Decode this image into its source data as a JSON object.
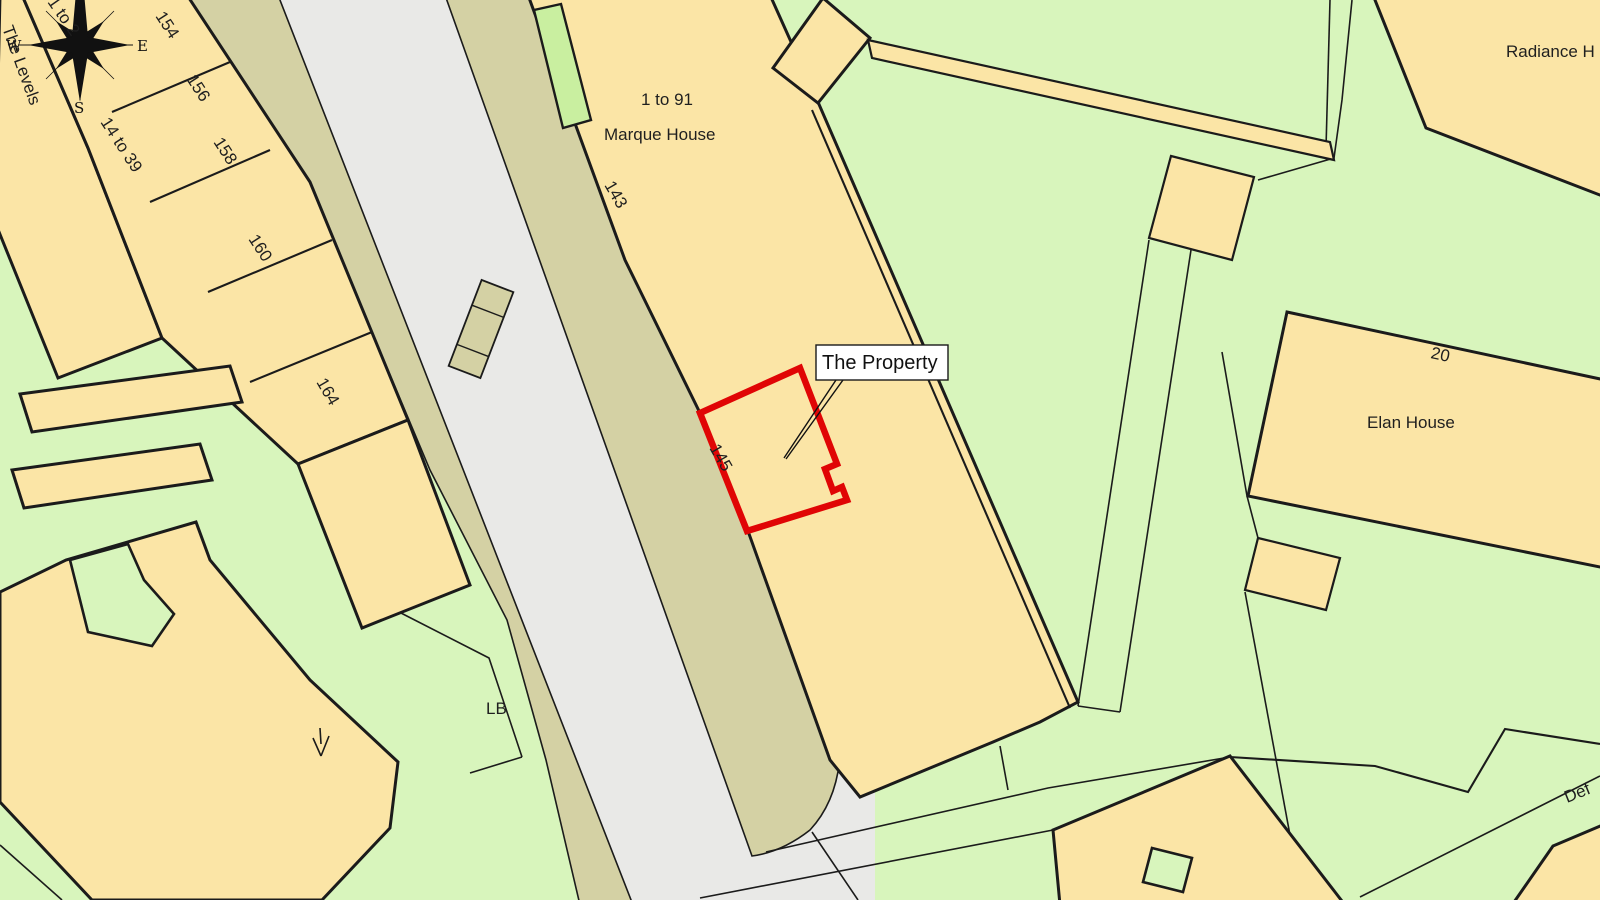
{
  "map": {
    "kind": "site-location-plan",
    "callout": {
      "label": "The Property"
    },
    "labels": {
      "the_levels": "The Levels",
      "one_to_2": "1 to 2",
      "fourteen_to_39": "14 to 39",
      "n154": "154",
      "n156": "156",
      "n158": "158",
      "n160": "160",
      "n164": "164",
      "one_to_91": "1 to 91",
      "marque_house": "Marque House",
      "n143": "143",
      "n145": "145",
      "lb": "LB",
      "radiance_house": "Radiance H",
      "n20": "20",
      "elan_house": "Elan House",
      "def": "Def"
    },
    "compass": {
      "west": "W",
      "east": "E",
      "south": "S"
    },
    "colors": {
      "building": "#FBE5A6",
      "green": "#D8F5BC",
      "green-bright": "#C9EFA0",
      "road": "#E9E9E7",
      "pavement": "#D4D1A4",
      "outline": "#1B1B1B",
      "property-red": "#E00505",
      "label-ink": "#1F1F1F"
    }
  }
}
